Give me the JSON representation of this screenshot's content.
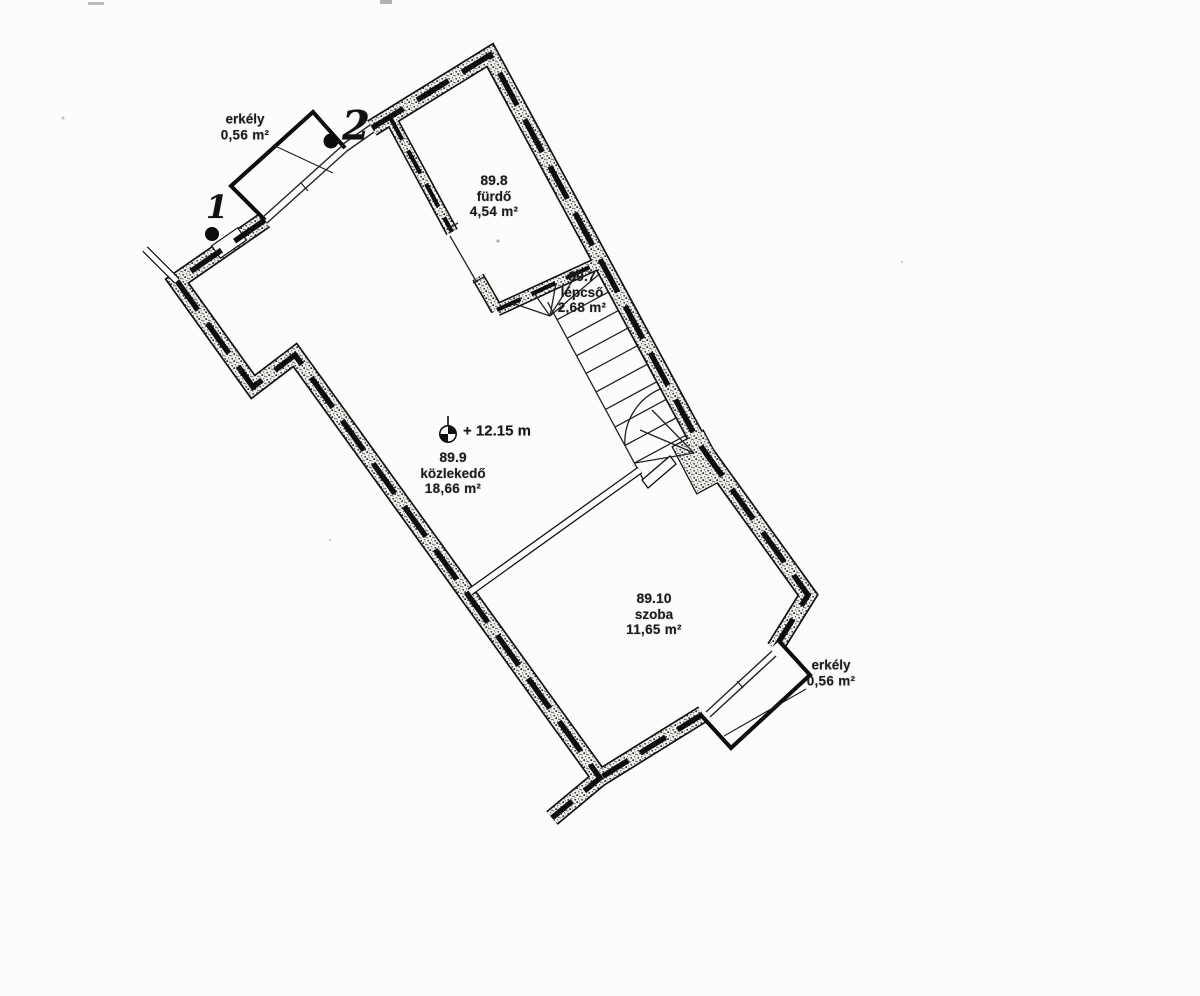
{
  "document": {
    "type": "floor-plan-scan",
    "language": "hu",
    "paper_color": "#fcfcfa",
    "ink_color": "#1b1b1b"
  },
  "plan": {
    "rooms": [
      {
        "id": "89.8",
        "name": "fürdő",
        "area": "4,54 m²"
      },
      {
        "id": "89.7",
        "name": "lépcső",
        "area": "2,68 m²"
      },
      {
        "id": "89.9",
        "name": "közlekedő",
        "area": "18,66 m²"
      },
      {
        "id": "89.10",
        "name": "szoba",
        "area": "11,65 m²"
      }
    ],
    "balcony_top": {
      "name": "erkély",
      "area": "0,56 m²"
    },
    "balcony_bottom": {
      "name": "erkély",
      "area": "0,56 m²"
    },
    "elevation": {
      "label": "+ 12.15 m",
      "symbol": "benchmark-icon"
    },
    "markers": [
      {
        "label": "1",
        "symbol": "survey-point-dot"
      },
      {
        "label": "2",
        "symbol": "survey-point-dot"
      }
    ]
  }
}
